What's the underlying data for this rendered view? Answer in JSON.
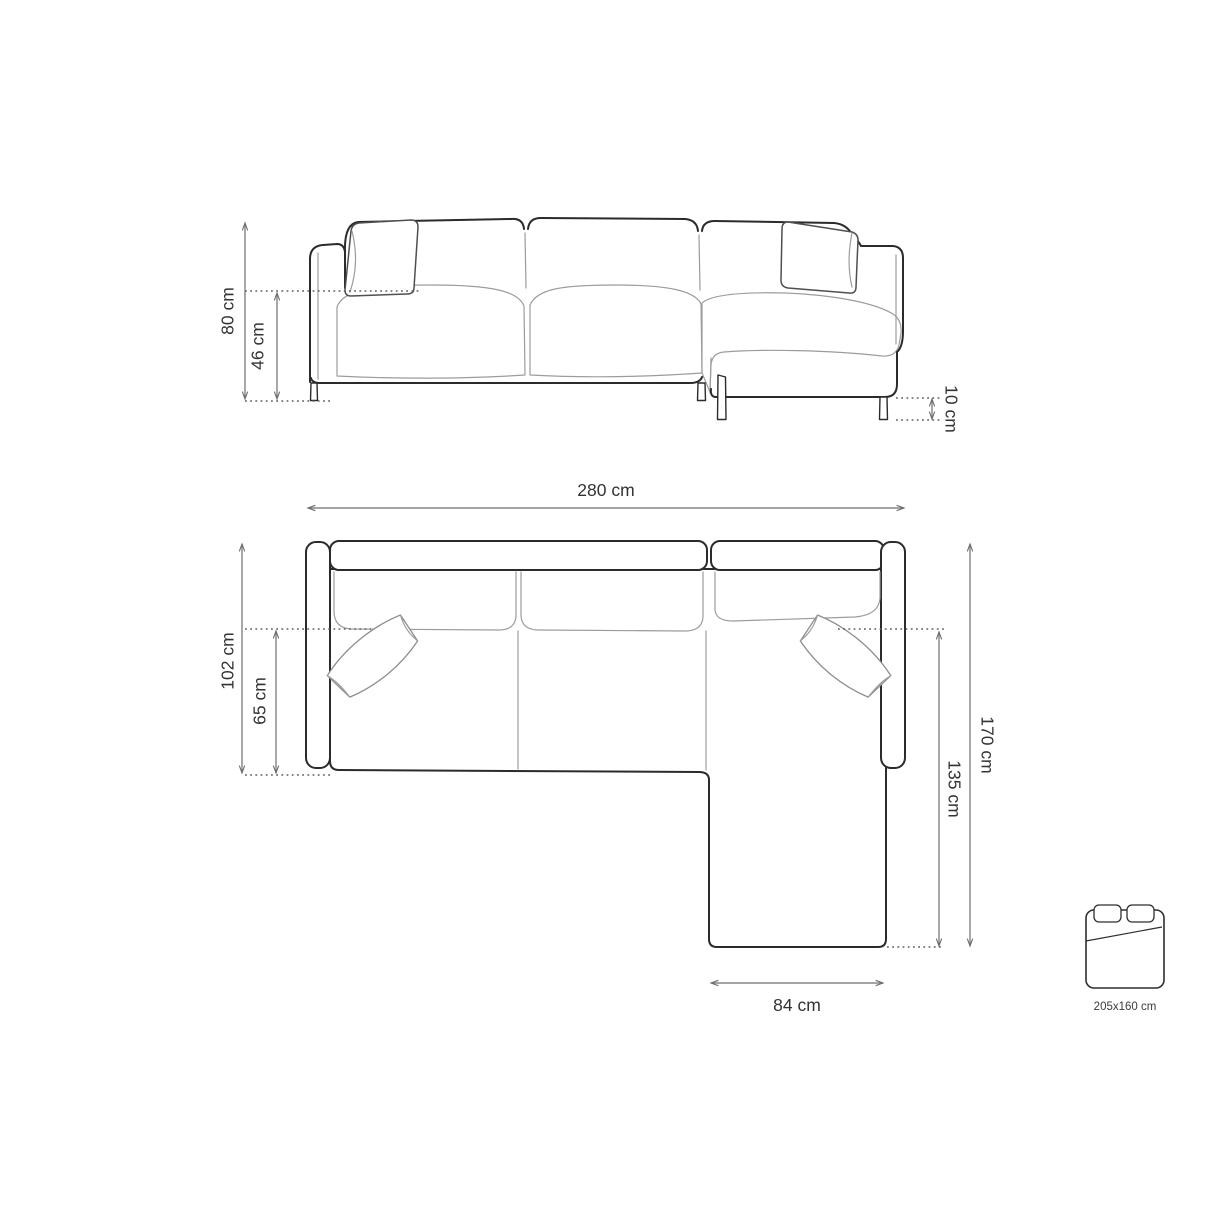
{
  "views": {
    "front": {
      "title": "sofa front elevation",
      "dims": {
        "total_height": "80 cm",
        "seat_height": "46 cm",
        "leg_height": "10 cm"
      }
    },
    "top": {
      "title": "sofa top plan",
      "dims": {
        "total_width": "280 cm",
        "total_depth": "102 cm",
        "seat_depth": "65 cm",
        "chaise_depth_total": "170 cm",
        "chaise_depth": "135 cm",
        "chaise_width": "84 cm"
      }
    },
    "sleeping": {
      "label": "205x160 cm"
    }
  },
  "colors": {
    "background": "#ffffff",
    "outline": "#2b2b2b",
    "seam": "#9c9c9c",
    "dimension_line": "#6e6e6e",
    "label_text": "#333333"
  }
}
